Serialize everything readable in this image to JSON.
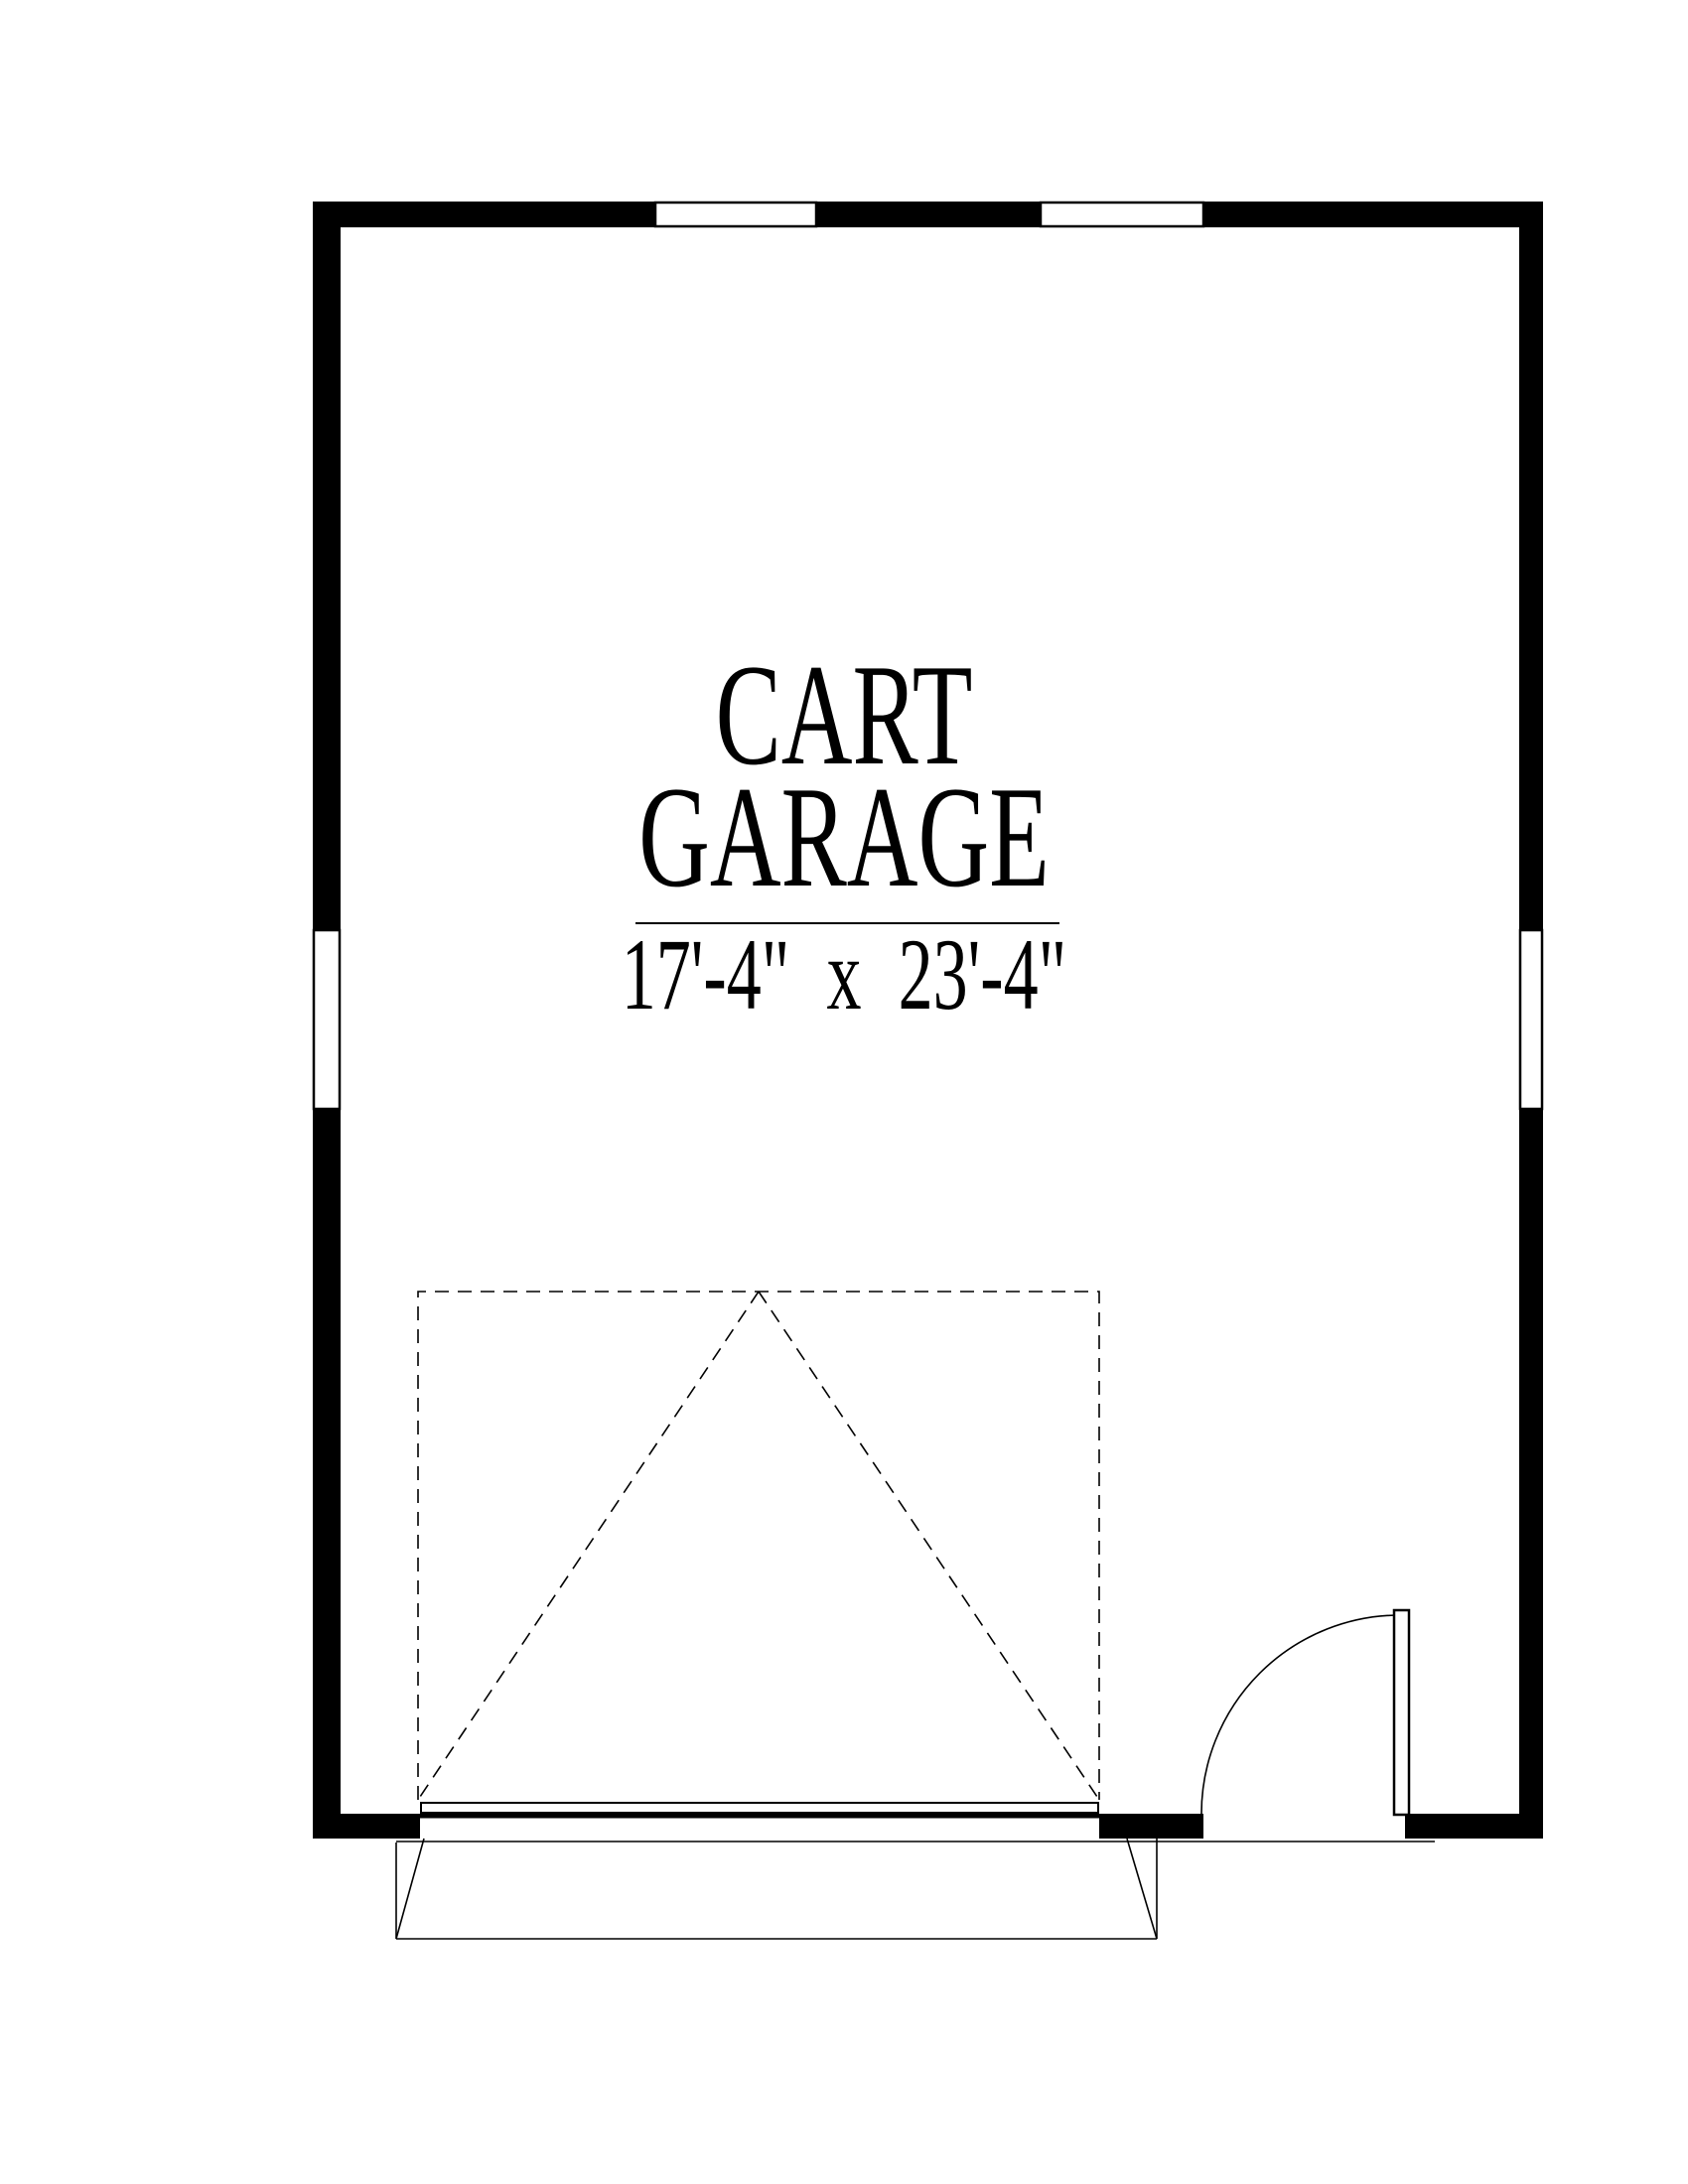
{
  "page": {
    "background_color": "#ffffff",
    "ink_color": "#000000"
  },
  "room_label": {
    "title_line1": "CART",
    "title_line2": "GARAGE",
    "dimensions": "17'-4\" x 23'-4\""
  },
  "plan": {
    "room_name": "CART GARAGE",
    "room_size": "17'-4\" x 23'-4\"",
    "elements": [
      "exterior walls",
      "two windows in top wall",
      "window in left wall",
      "window in right wall",
      "overhead garage door with dashed swing symbol",
      "hinged entry door with quarter-circle swing arc",
      "driveway apron"
    ]
  }
}
